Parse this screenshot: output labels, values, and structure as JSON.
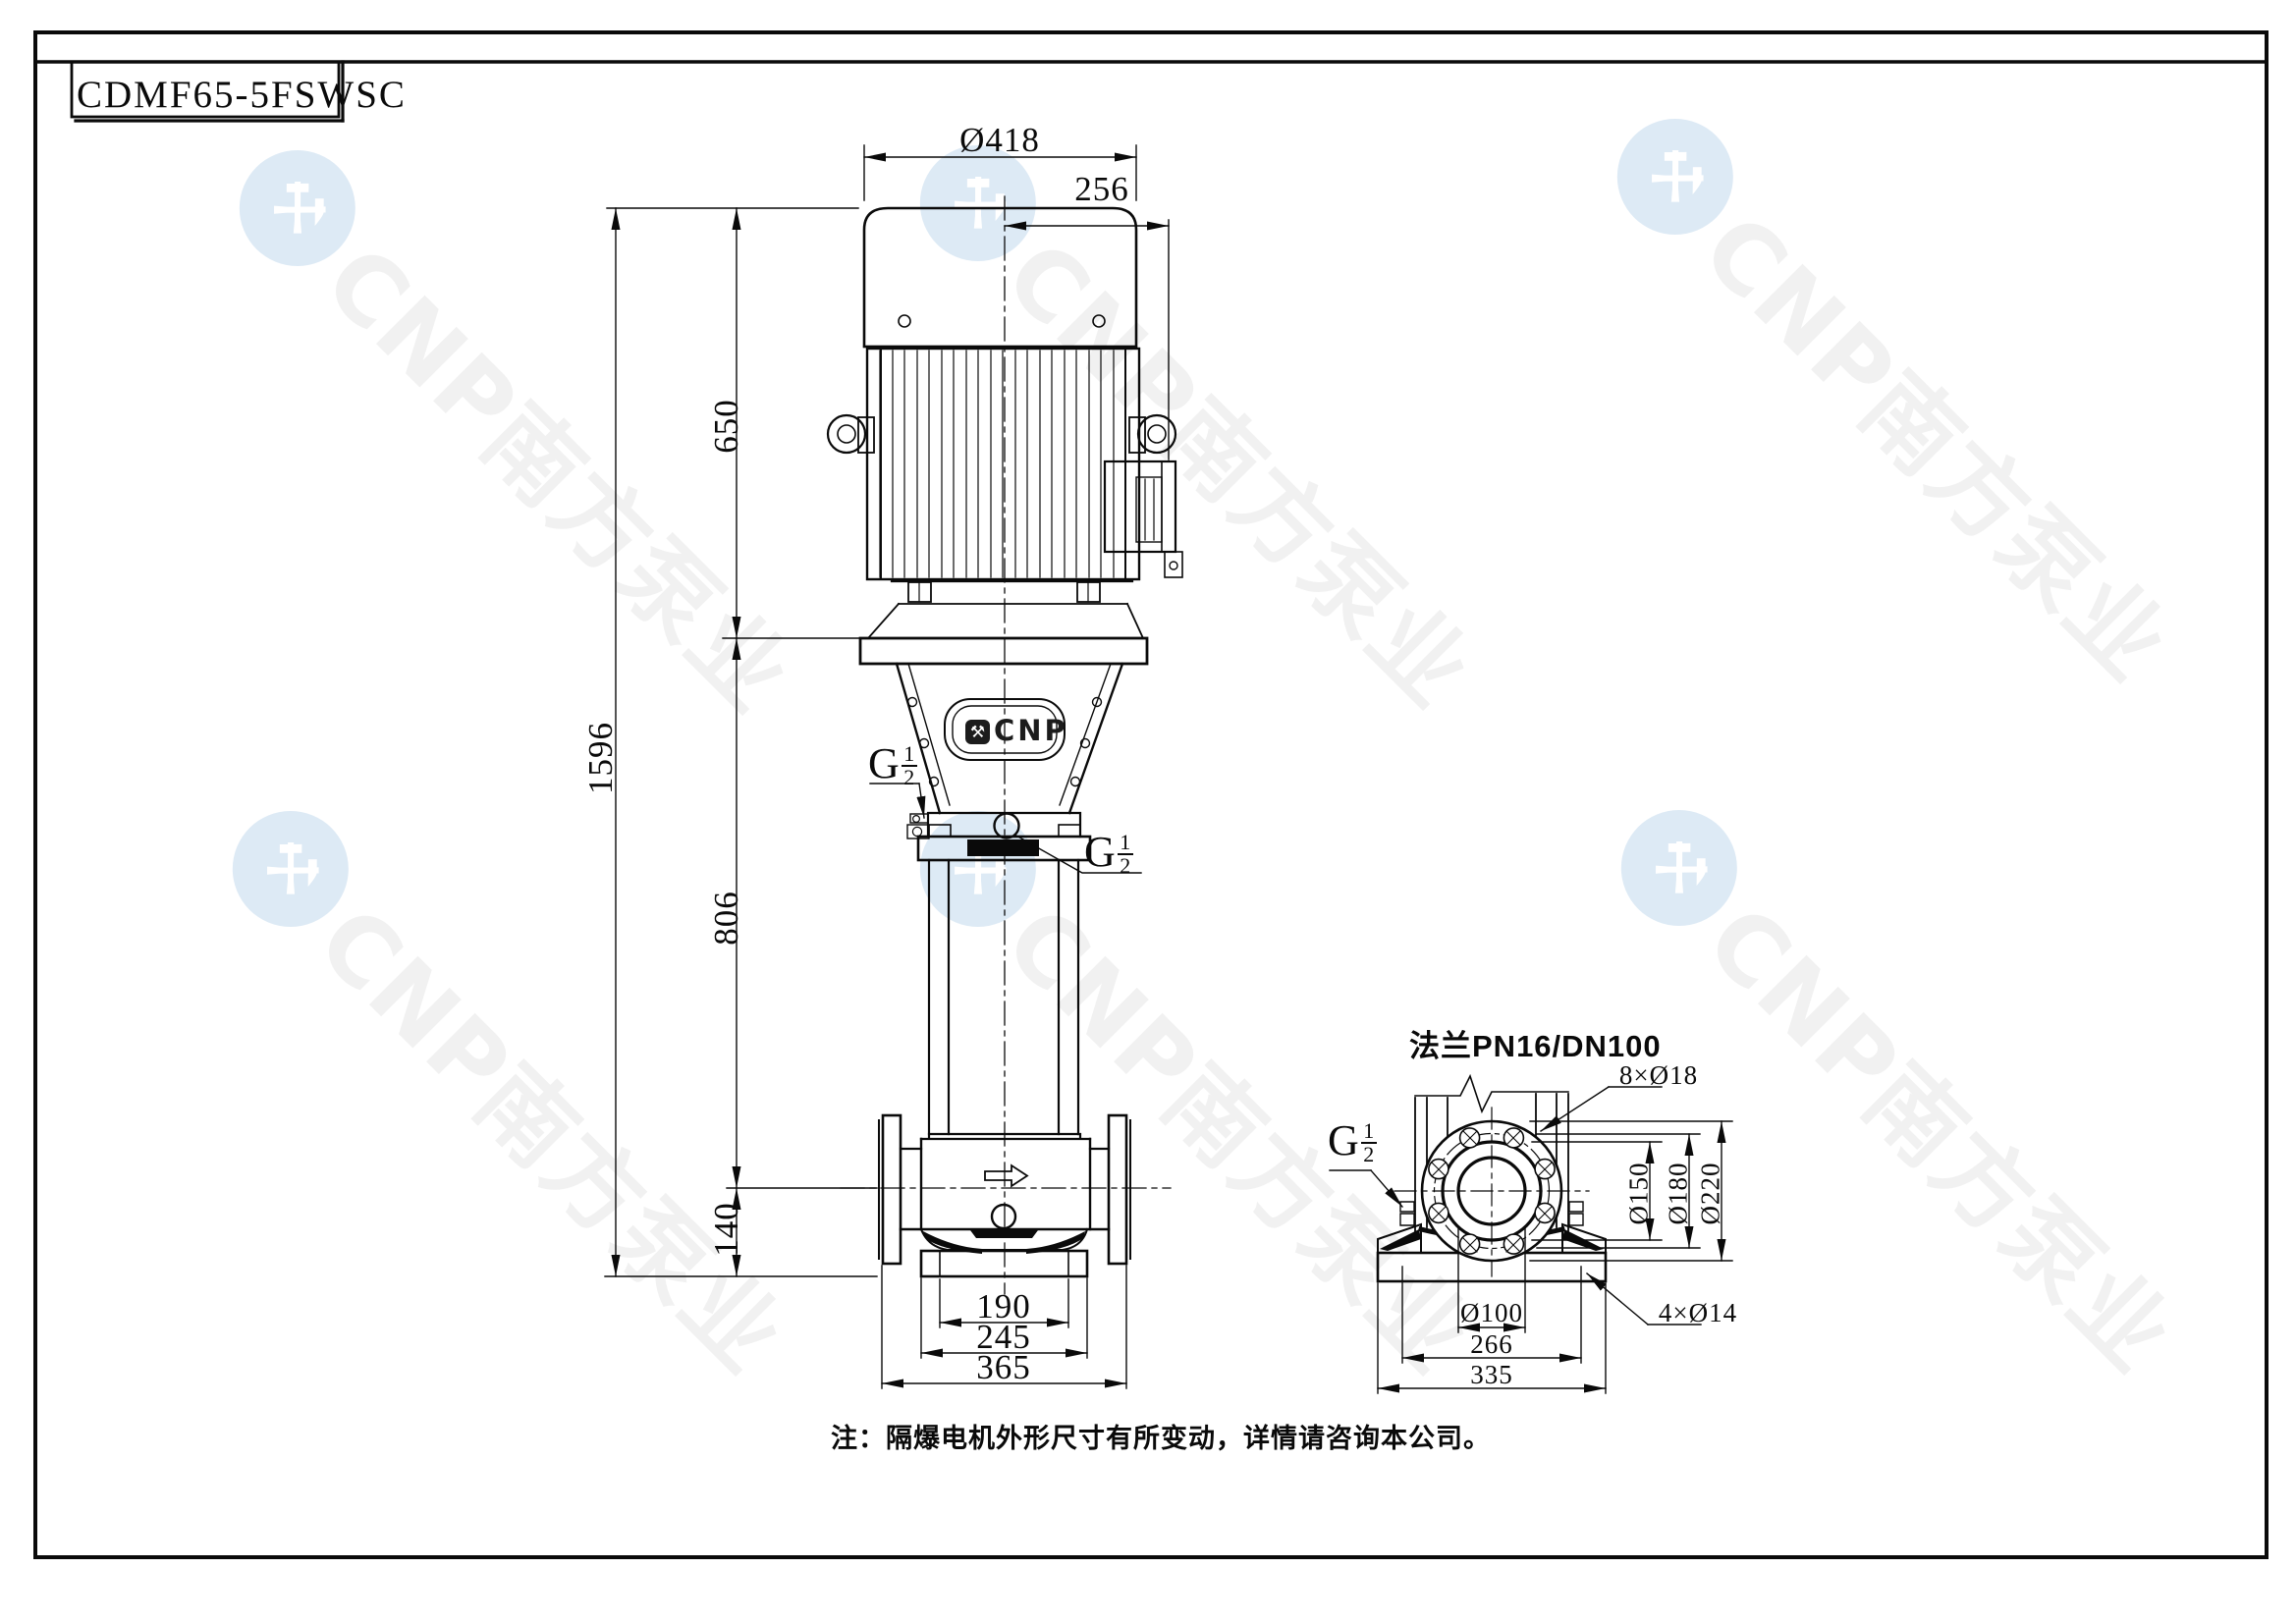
{
  "title_block": {
    "model": "CDMF65-5FSWSC"
  },
  "watermark": {
    "text": "CNP南方泵业",
    "logo": "hammer-icon"
  },
  "brand_plate": {
    "name": "CNP",
    "logo": "hammer-icon"
  },
  "note": "注：隔爆电机外形尺寸有所变动，详情请咨询本公司。",
  "labels": {
    "g": "G",
    "g_num": "1",
    "g_den": "2"
  },
  "main_view": {
    "dim_fan_cover_dia": "Ø418",
    "dim_box_offset": "256",
    "dim_motor_height": "650",
    "dim_total_height": "1596",
    "dim_pump_height": "806",
    "dim_port_center_height": "140",
    "dim_base_inner": "190",
    "dim_base_mid": "245",
    "dim_base_outer": "365"
  },
  "flange_view": {
    "title": "法兰PN16/DN100",
    "dim_bolt_holes": "8×Ø18",
    "dim_raised_face": "Ø150",
    "dim_bolt_circle": "Ø180",
    "dim_outer_dia": "Ø220",
    "dim_bore": "Ø100",
    "dim_base_mid": "266",
    "dim_base_outer": "335",
    "dim_base_holes": "4×Ø14"
  }
}
